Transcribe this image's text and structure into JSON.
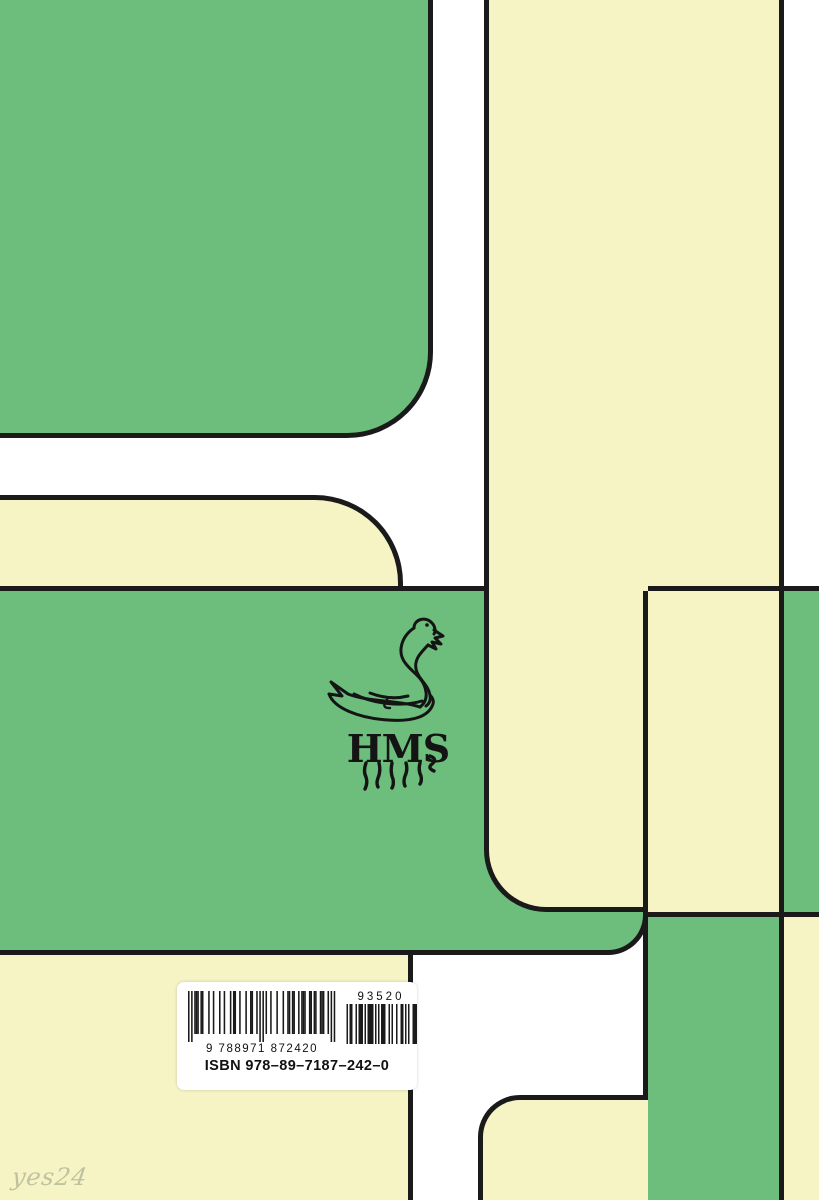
{
  "cover": {
    "colors": {
      "green": "#6dbe7d",
      "cream": "#f6f4c5",
      "line": "#1a1a1a",
      "white": "#ffffff",
      "label": "#ffffff"
    },
    "logo": {
      "initials": "HMS",
      "icon": "swan"
    },
    "barcode": {
      "ean_label": "9 788971 872420",
      "addon_label": "93520",
      "isbn_label": "ISBN 978–89–7187–242–0",
      "main_pattern": "10101110110001001000100100010110010001001100101010100100010001001101100101110011011001110010101",
      "addon_pattern": "010110010111010111101010111001010010011010100111"
    },
    "watermark": "yes24"
  }
}
